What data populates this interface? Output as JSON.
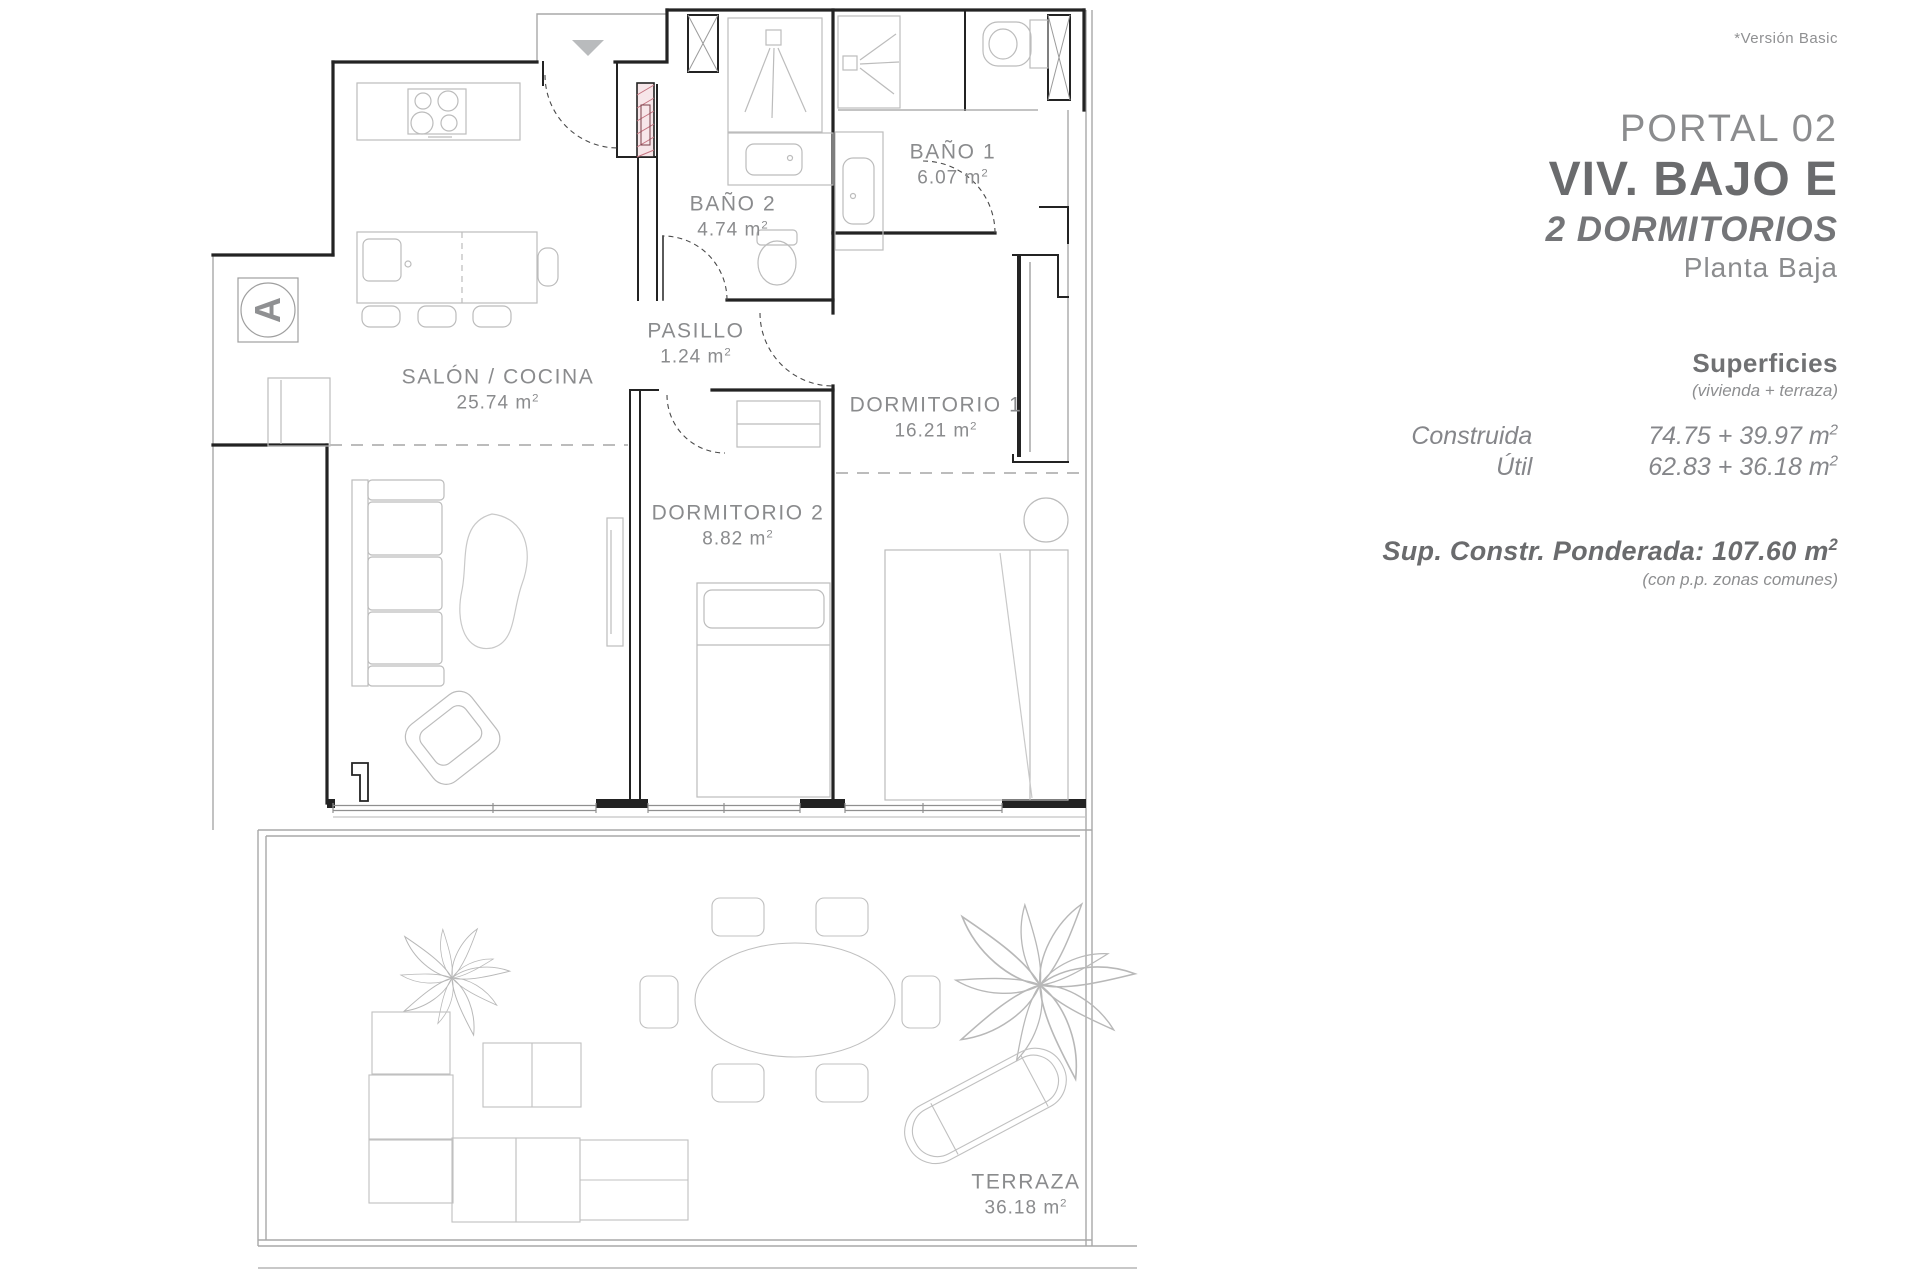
{
  "header_note": "*Versión Basic",
  "info_panel": {
    "portal": "PORTAL 02",
    "unit": "VIV. BAJO E",
    "bedrooms": "2 DORMITORIOS",
    "floor": "Planta Baja",
    "surfaces": {
      "title": "Superficies",
      "subtitle": "(vivienda + terraza)",
      "rows": [
        {
          "label": "Construida",
          "value": "74.75 + 39.97"
        },
        {
          "label": "Útil",
          "value": "62.83 + 36.18"
        }
      ],
      "unit": "m",
      "unit_exp": "2"
    },
    "weighted": {
      "label": "Sup. Constr. Ponderada:",
      "value": "107.60",
      "note": "(con p.p. zonas comunes)"
    }
  },
  "plan": {
    "section_marker": "A",
    "unit": "m",
    "unit_exp": "2",
    "rooms": [
      {
        "name": "BAÑO 2",
        "area": "4.74"
      },
      {
        "name": "BAÑO 1",
        "area": "6.07"
      },
      {
        "name": "PASILLO",
        "area": "1.24"
      },
      {
        "name": "SALÓN / COCINA",
        "area": "25.74"
      },
      {
        "name": "DORMITORIO 1",
        "area": "16.21"
      },
      {
        "name": "DORMITORIO 2",
        "area": "8.82"
      },
      {
        "name": "TERRAZA",
        "area": "36.18"
      }
    ]
  },
  "colors": {
    "wall": "#232323",
    "furniture": "#bcbcbc",
    "label_text": "#8a8b8d",
    "hatch_accent": "#c4737f",
    "hatch_fill": "#f7e6e9"
  }
}
